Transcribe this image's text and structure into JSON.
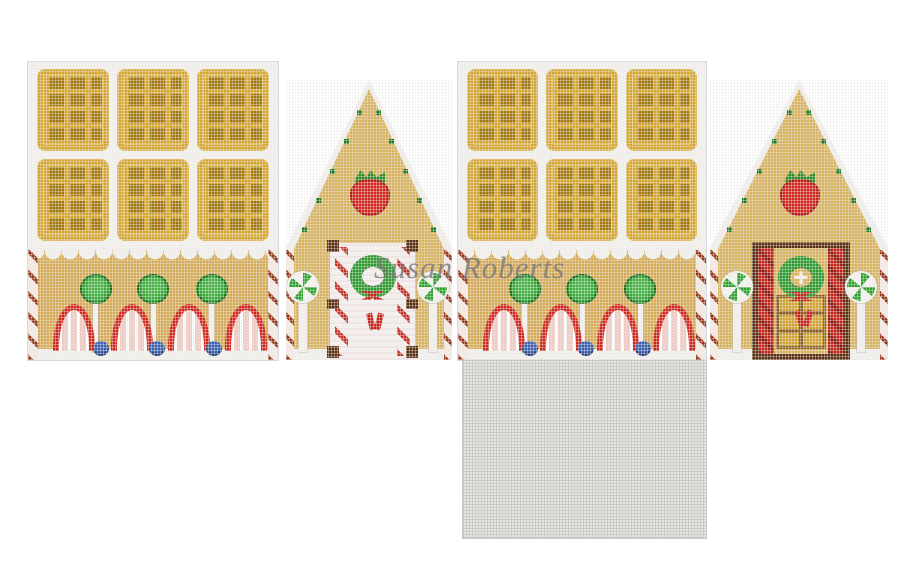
{
  "canvas": {
    "watermark": "Susan Roberts",
    "subject": "gingerbread house 3-D needlepoint canvas layout",
    "panels": [
      {
        "id": "side-wall-left",
        "description": "side wall with 6 waffle roof tiles, 4 strawberry icing arches, 3 green lollipops, 3 blueberries, candy-stripe edges"
      },
      {
        "id": "gable-front",
        "description": "gable end with strawberry, icing-dot slopes, white candy-stripe door with wreath, 2 peppermint posts"
      },
      {
        "id": "side-wall-right",
        "description": "side wall with 6 waffle roof tiles, 4 strawberry icing arches, 3 green lollipops, 3 blueberries, candy-stripe edges"
      },
      {
        "id": "gable-back",
        "description": "gable end with strawberry, icing-dot slopes, wooden door with red candy jambs, 6-pane window, wreath, 2 peppermint posts"
      },
      {
        "id": "base",
        "description": "blank stitched base square"
      }
    ],
    "colors": {
      "page_background": "#ffffff",
      "canvas_white": "#f3f2ee",
      "waffle_gold": "#d4a52f",
      "waffle_pocket": "#a1770e",
      "wall_tan": "#d7ab55",
      "gable_tan": "#d9b25e",
      "candy_red": "#c6241a",
      "leaf_green": "#2c9a2e",
      "dot_green": "#1e7a22",
      "berry_blue": "#3b60b0",
      "door_brown": "#5a2e12",
      "base_gray": "#e5e4e0",
      "watermark_gray": "#7a7a7a"
    }
  }
}
